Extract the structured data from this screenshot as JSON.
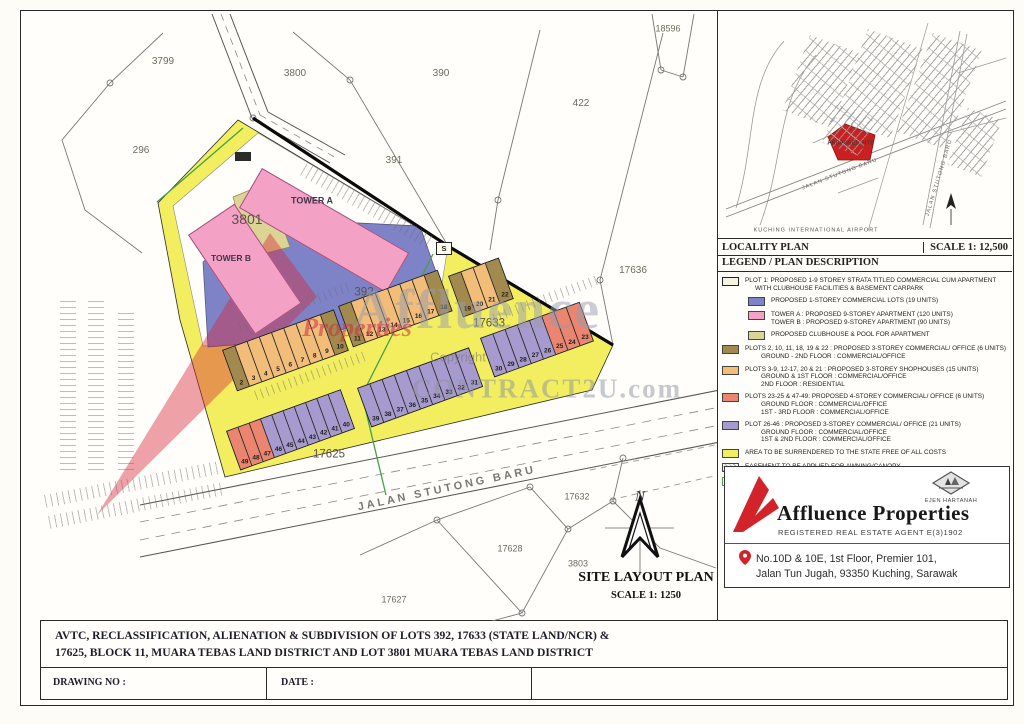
{
  "colors": {
    "yellow": "#f2ee60",
    "blue": "#7d83c6",
    "pink": "#f3a2c6",
    "clubhouse": "#dcd494",
    "olive": "#a2894e",
    "orange": "#f2bd79",
    "red": "#ec8570",
    "purple": "#a79ace",
    "green": "#44a04a",
    "accent": "#d2232a"
  },
  "site_plan": {
    "title": "SITE LAYOUT PLAN",
    "scale": "SCALE  1: 1250",
    "road_label": "JALAN  STUTONG  BARU",
    "north_label": "N",
    "substation_label": "S",
    "labels": [
      {
        "name": "lot-18596",
        "text": "18596",
        "x": 646,
        "y": 16,
        "size": 9
      },
      {
        "name": "lot-3799",
        "text": "3799",
        "x": 141,
        "y": 49,
        "size": 10
      },
      {
        "name": "lot-3800",
        "text": "3800",
        "x": 273,
        "y": 61,
        "size": 10
      },
      {
        "name": "lot-390",
        "text": "390",
        "x": 419,
        "y": 61,
        "size": 10
      },
      {
        "name": "lot-391",
        "text": "391",
        "x": 372,
        "y": 148,
        "size": 10
      },
      {
        "name": "lot-422",
        "text": "422",
        "x": 559,
        "y": 91,
        "size": 10
      },
      {
        "name": "lot-296",
        "text": "296",
        "x": 119,
        "y": 138,
        "size": 10
      },
      {
        "name": "lot-17636",
        "text": "17636",
        "x": 611,
        "y": 258,
        "size": 10
      },
      {
        "name": "lot-3801",
        "text": "3801",
        "x": 225,
        "y": 206,
        "size": 14,
        "color": "#57534a"
      },
      {
        "name": "lot-392",
        "text": "392",
        "x": 342,
        "y": 280,
        "size": 11.5,
        "color": "#57534a"
      },
      {
        "name": "lot-17633",
        "text": "17633",
        "x": 467,
        "y": 311,
        "size": 11.5,
        "color": "#57534a"
      },
      {
        "name": "lot-17625",
        "text": "17625",
        "x": 307,
        "y": 442,
        "size": 11.5,
        "color": "#57534a"
      },
      {
        "name": "lot-17632",
        "text": "17632",
        "x": 555,
        "y": 484,
        "size": 9
      },
      {
        "name": "lot-17628",
        "text": "17628",
        "x": 488,
        "y": 536,
        "size": 9
      },
      {
        "name": "lot-3803",
        "text": "3803",
        "x": 556,
        "y": 551,
        "size": 9
      },
      {
        "name": "lot-17627",
        "text": "17627",
        "x": 372,
        "y": 587,
        "size": 9
      },
      {
        "name": "tower-a-label",
        "text": "TOWER A",
        "x": 290,
        "y": 188,
        "size": 9,
        "bold": true,
        "color": "#43334a"
      },
      {
        "name": "tower-b-label",
        "text": "TOWER B",
        "x": 209,
        "y": 245,
        "size": 8.5,
        "bold": true,
        "color": "#43334a"
      },
      {
        "name": "road-label",
        "text": "JALAN  STUTONG  BARU",
        "x": 425,
        "y": 476,
        "size": 11,
        "rot": -12,
        "ls": 3,
        "w": 600,
        "color": "#777"
      },
      {
        "name": "site-plan-title",
        "text": "SITE LAYOUT PLAN",
        "x": 624,
        "y": 565,
        "size": 14,
        "bold": true,
        "serif": true,
        "color": "#111"
      },
      {
        "name": "site-plan-scale",
        "text": "SCALE  1: 1250",
        "x": 624,
        "y": 583,
        "size": 10.5,
        "bold": true,
        "serif": true,
        "color": "#111"
      },
      {
        "name": "north-label",
        "text": "N",
        "x": 618,
        "y": 484,
        "size": 15,
        "italic": true,
        "serif": true,
        "color": "#333"
      }
    ],
    "plot_rows": [
      {
        "x": 200,
        "y": 337,
        "angle": -20,
        "w": 13,
        "h": 42,
        "cells": [
          {
            "n": "2",
            "c": "olive"
          },
          {
            "n": "3",
            "c": "orange"
          },
          {
            "n": "4",
            "c": "orange"
          },
          {
            "n": "5",
            "c": "orange"
          },
          {
            "n": "6",
            "c": "orange"
          },
          {
            "n": "7",
            "c": "orange"
          },
          {
            "n": "8",
            "c": "orange"
          },
          {
            "n": "9",
            "c": "orange"
          },
          {
            "n": "10",
            "c": "olive"
          }
        ]
      },
      {
        "x": 316,
        "y": 293,
        "angle": -20,
        "w": 13,
        "h": 42,
        "cells": [
          {
            "n": "11",
            "c": "olive"
          },
          {
            "n": "12",
            "c": "orange"
          },
          {
            "n": "13",
            "c": "orange"
          },
          {
            "n": "14",
            "c": "orange"
          },
          {
            "n": "15",
            "c": "orange"
          },
          {
            "n": "16",
            "c": "orange"
          },
          {
            "n": "17",
            "c": "orange"
          },
          {
            "n": "18",
            "c": "olive"
          }
        ]
      },
      {
        "x": 426,
        "y": 263,
        "angle": -20,
        "w": 13,
        "h": 42,
        "cells": [
          {
            "n": "19",
            "c": "olive"
          },
          {
            "n": "20",
            "c": "orange"
          },
          {
            "n": "21",
            "c": "orange"
          },
          {
            "n": "22",
            "c": "olive"
          }
        ]
      },
      {
        "x": 458,
        "y": 325,
        "angle": -20,
        "w": 13,
        "h": 40,
        "cells": [
          {
            "n": "30",
            "c": "purple"
          },
          {
            "n": "29",
            "c": "purple"
          },
          {
            "n": "28",
            "c": "purple"
          },
          {
            "n": "27",
            "c": "purple"
          },
          {
            "n": "26",
            "c": "purple"
          },
          {
            "n": "25",
            "c": "red"
          },
          {
            "n": "24",
            "c": "red"
          },
          {
            "n": "23",
            "c": "red"
          }
        ]
      },
      {
        "x": 335,
        "y": 375,
        "angle": -20,
        "w": 13,
        "h": 40,
        "cells": [
          {
            "n": "39",
            "c": "purple"
          },
          {
            "n": "38",
            "c": "purple"
          },
          {
            "n": "37",
            "c": "purple"
          },
          {
            "n": "36",
            "c": "purple"
          },
          {
            "n": "35",
            "c": "purple"
          },
          {
            "n": "34",
            "c": "purple"
          },
          {
            "n": "33",
            "c": "purple"
          },
          {
            "n": "32",
            "c": "purple"
          },
          {
            "n": "31",
            "c": "purple"
          }
        ]
      },
      {
        "x": 204,
        "y": 418,
        "angle": -20,
        "w": 12,
        "h": 40,
        "cells": [
          {
            "n": "49",
            "c": "red"
          },
          {
            "n": "48",
            "c": "red"
          },
          {
            "n": "47",
            "c": "red"
          },
          {
            "n": "46",
            "c": "purple"
          },
          {
            "n": "45",
            "c": "purple"
          },
          {
            "n": "44",
            "c": "purple"
          },
          {
            "n": "43",
            "c": "purple"
          },
          {
            "n": "42",
            "c": "purple"
          },
          {
            "n": "41",
            "c": "purple"
          },
          {
            "n": "40",
            "c": "purple"
          }
        ]
      }
    ]
  },
  "watermark": {
    "affluence": "Affluence",
    "properties": "Properties",
    "copyright": "Copyright",
    "contract": "CONTRACT2U.com"
  },
  "locality": {
    "title": "LOCALITY PLAN",
    "scale": "SCALE 1: 12,500",
    "site_label": "PROPOSED SITE",
    "road_label": "JALAN STUTONG BARU",
    "road_label2": "JALAN STUTONG BARU",
    "airport_label": "KUCHING INTERNATIONAL AIRPORT"
  },
  "legend": {
    "title": "LEGEND / PLAN DESCRIPTION",
    "entries": [
      {
        "swatch": "plot1",
        "indent": false,
        "lines": [
          {
            "t": "PLOT 1: PROPOSED 1-9 STOREY STRATA TITLED COMMERCIAL CUM APARTMENT",
            "i": 0
          },
          {
            "t": "WITH CLUBHOUSE FACILITIES & BASEMENT CARPARK",
            "i": 1
          }
        ]
      },
      {
        "swatch": "blue",
        "indent": true,
        "lines": [
          {
            "t": "PROPOSED 1-STOREY COMMERCIAL LOTS (19 UNITS)",
            "i": 0
          }
        ]
      },
      {
        "swatch": "pink",
        "indent": true,
        "lines": [
          {
            "t": "TOWER A : PROPOSED 9-STOREY APARTMENT (120 UNITS)",
            "i": 0
          },
          {
            "t": "TOWER B : PROPOSED 9-STOREY APARTMENT (90 UNITS)",
            "i": 0
          }
        ]
      },
      {
        "swatch": "clubhouse",
        "indent": true,
        "lines": [
          {
            "t": "PROPOSED CLUBHOUSE & POOL FOR APARTMENT",
            "i": 0
          }
        ]
      },
      {
        "swatch": "olive",
        "indent": false,
        "lines": [
          {
            "t": "PLOTS 2, 10, 11, 18, 19 & 22 : PROPOSED 3-STOREY COMMERCIAL/ OFFICE (6 UNITS)",
            "i": 0
          },
          {
            "t": "GROUND - 2ND FLOOR : COMMERCIAL/OFFICE",
            "i": 2
          }
        ]
      },
      {
        "swatch": "orange",
        "indent": false,
        "lines": [
          {
            "t": "PLOTS 3-9, 12-17, 20 & 21 : PROPOSED 3-STOREY SHOPHOUSES (15 UNITS)",
            "i": 0
          },
          {
            "t": "GROUND & 1ST FLOOR : COMMERCIAL/OFFICE",
            "i": 2
          },
          {
            "t": "2ND FLOOR : RESIDENTIAL",
            "i": 2
          }
        ]
      },
      {
        "swatch": "red",
        "indent": false,
        "lines": [
          {
            "t": "PLOTS 23-25 & 47-49: PROPOSED 4-STOREY COMMERCIAL/ OFFICE (6 UNITS)",
            "i": 0
          },
          {
            "t": "GROUND FLOOR : COMMERCIAL/OFFICE",
            "i": 2
          },
          {
            "t": "1ST - 3RD FLOOR : COMMERCIAL/OFFICE",
            "i": 2
          }
        ]
      },
      {
        "swatch": "purple",
        "indent": false,
        "lines": [
          {
            "t": "PLOT 26-46 : PROPOSED 3-STOREY COMMERCIAL/ OFFICE  (21 UNITS)",
            "i": 0
          },
          {
            "t": "GROUND FLOOR : COMMERCIAL/OFFICE",
            "i": 2
          },
          {
            "t": "1ST & 2ND FLOOR : COMMERCIAL/OFFICE",
            "i": 2
          }
        ]
      },
      {
        "swatch": "yellow",
        "indent": false,
        "lines": [
          {
            "t": "AREA TO BE SURRENDERED TO THE STATE FREE OF ALL COSTS",
            "i": 0
          }
        ]
      },
      {
        "swatch": "easement",
        "indent": false,
        "lines": [
          {
            "t": "EASEMENT TO BE APPLIED FOR AWNING/CANOPY",
            "i": 0
          }
        ]
      },
      {
        "swatch": "stateland",
        "indent": false,
        "lines": [
          {
            "t": "ALIENATION OF STATE LAND SUBJECT TO PAYMENT OF PREMIUM",
            "i": 0
          }
        ]
      }
    ]
  },
  "agency": {
    "badge": "EJEN HARTANAH",
    "name": "Affluence Properties",
    "registration": "REGISTERED REAL ESTATE AGENT   E(3)1902",
    "address_line1": "No.10D & 10E, 1st Floor, Premier 101,",
    "address_line2": "Jalan Tun Jugah, 93350 Kuching, Sarawak"
  },
  "titleblock": {
    "line1": "AVTC, RECLASSIFICATION, ALIENATION & SUBDIVISION OF LOTS 392, 17633 (STATE LAND/NCR) &",
    "line2": "17625, BLOCK 11, MUARA TEBAS LAND DISTRICT AND LOT 3801 MUARA TEBAS LAND DISTRICT",
    "drawing_no_label": "DRAWING NO :",
    "date_label": "DATE :"
  }
}
